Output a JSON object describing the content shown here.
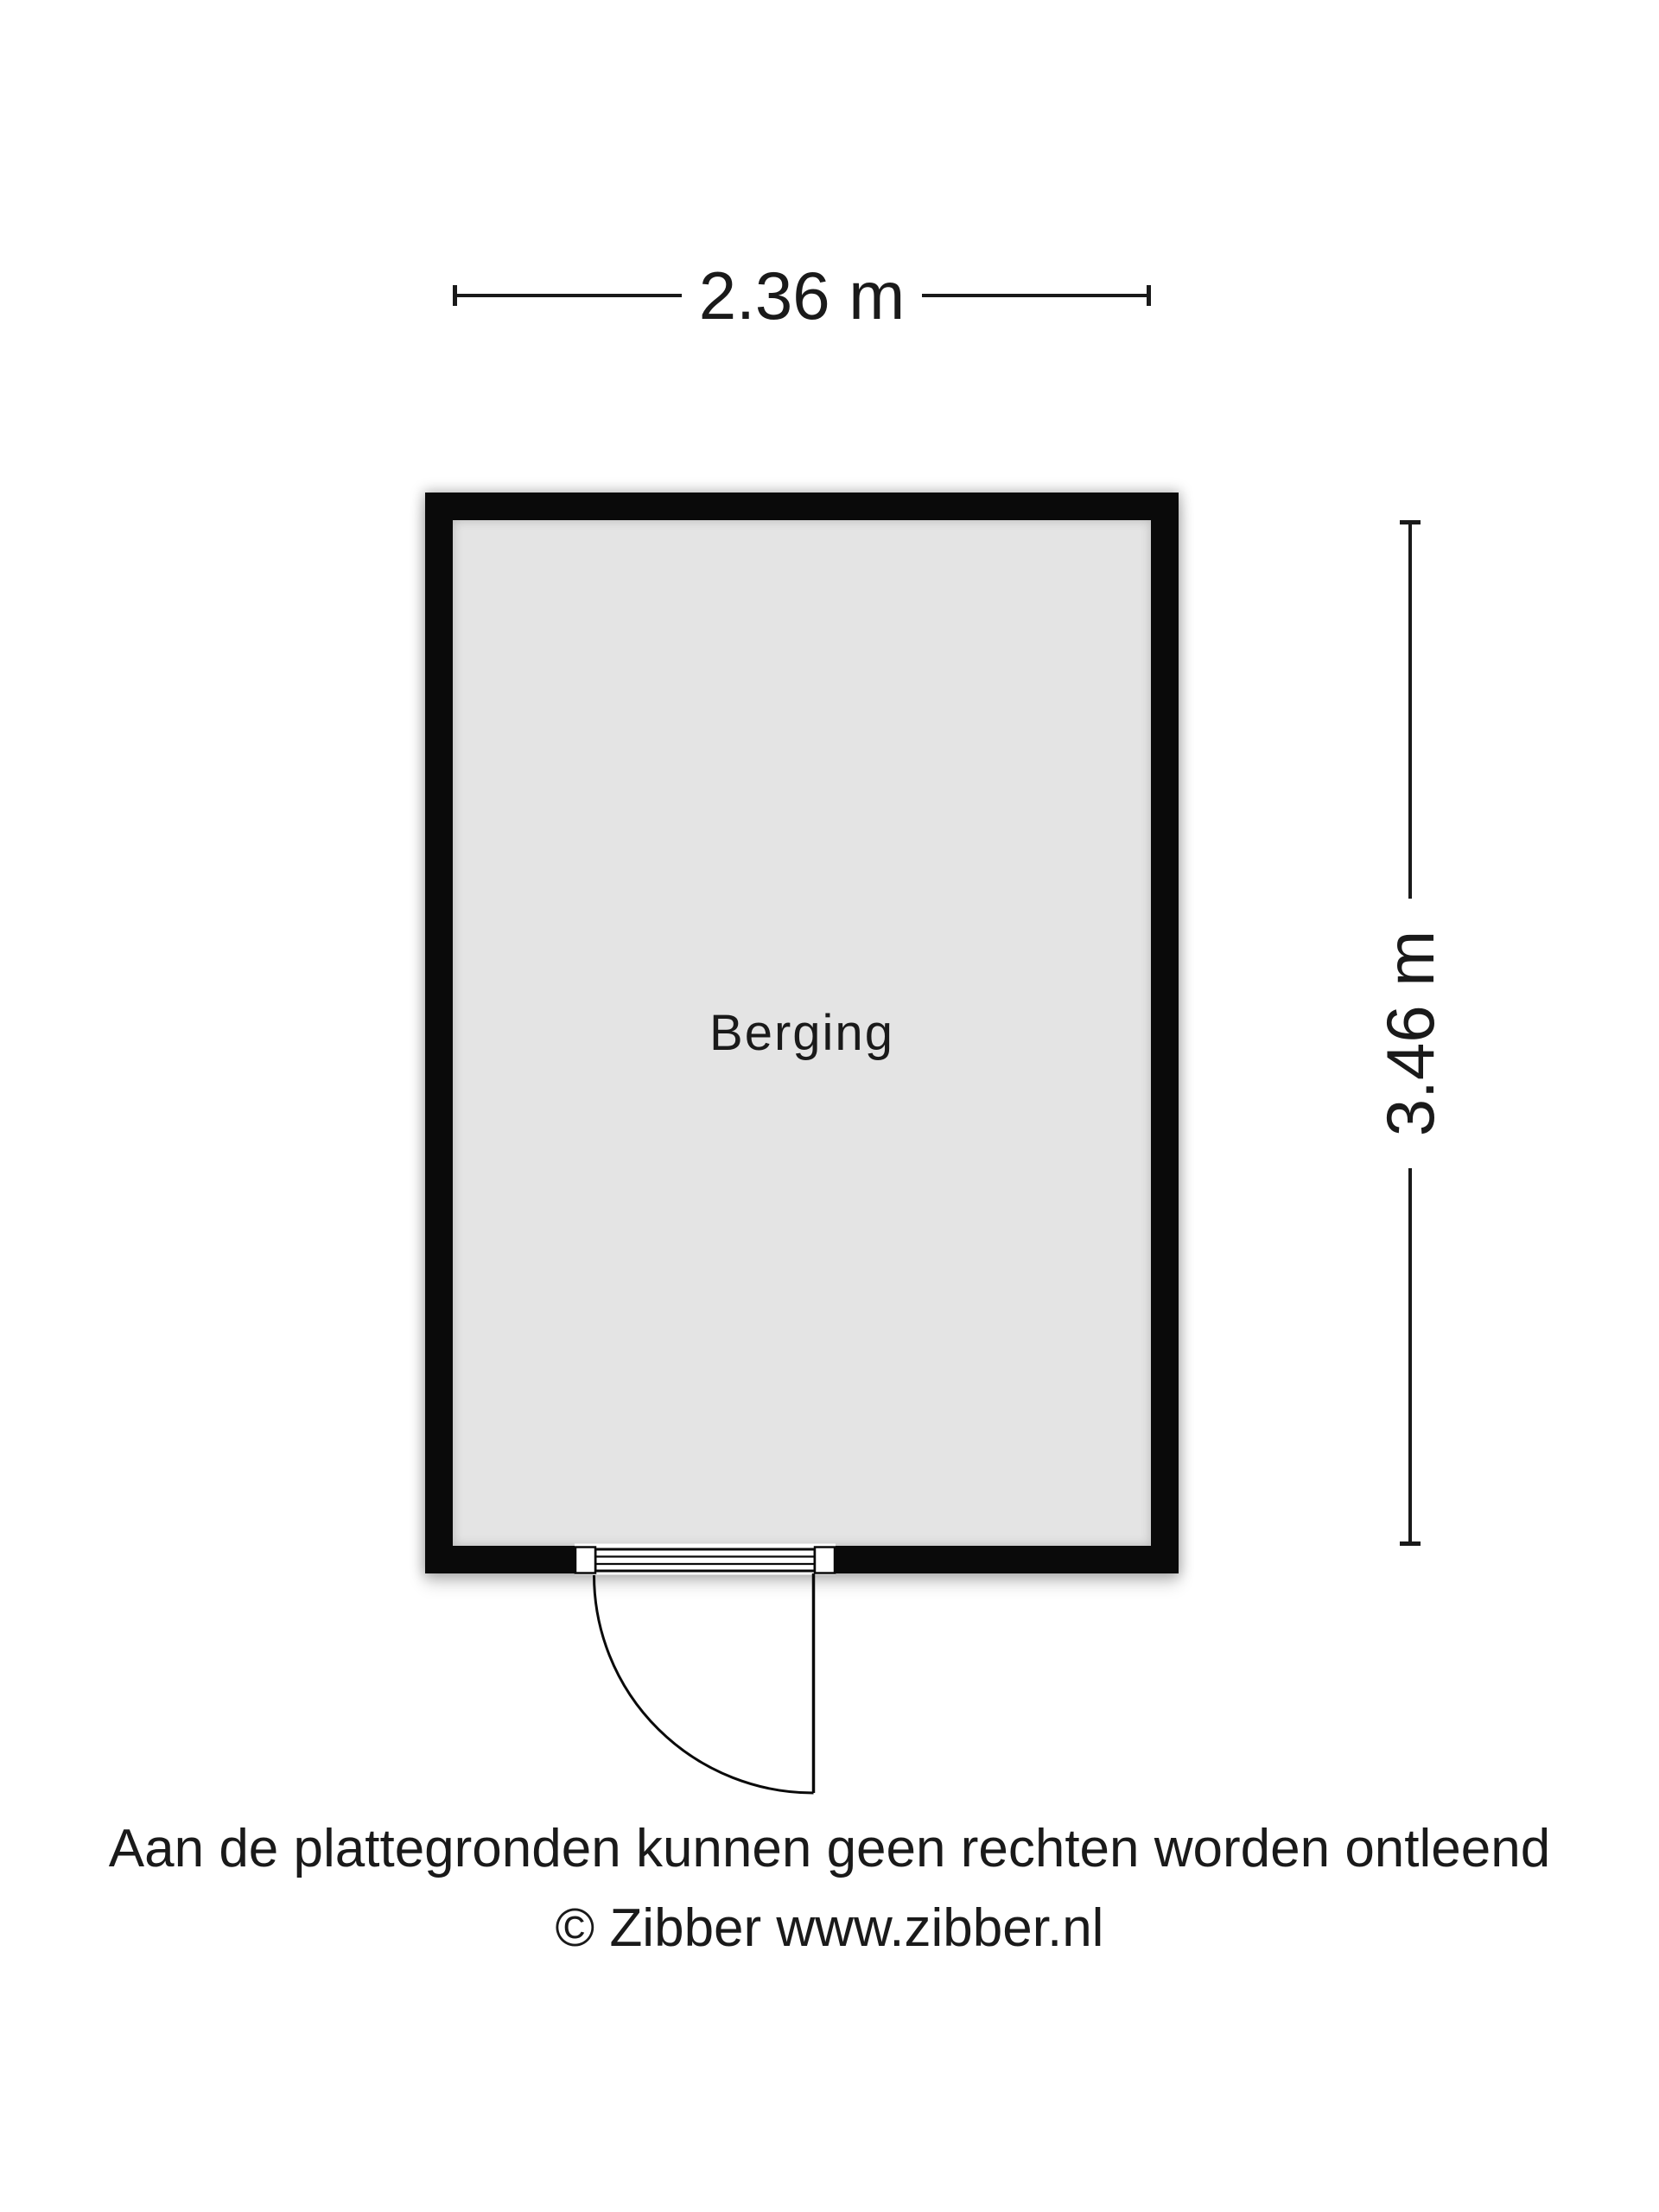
{
  "floor_plan": {
    "room": {
      "label": "Berging"
    },
    "dimensions": {
      "width": "2.36 m",
      "height": "3.46 m"
    },
    "door": {
      "type": "single-swing-door",
      "wall": "bottom"
    },
    "footer": {
      "line1": "Aan de plattegronden kunnen geen rechten worden ontleend",
      "line2": "© Zibber www.zibber.nl"
    },
    "colors": {
      "wall": "#0a0a0a",
      "room_fill": "#e4e4e4",
      "background": "#ffffff",
      "text": "#1a1a1a"
    }
  }
}
